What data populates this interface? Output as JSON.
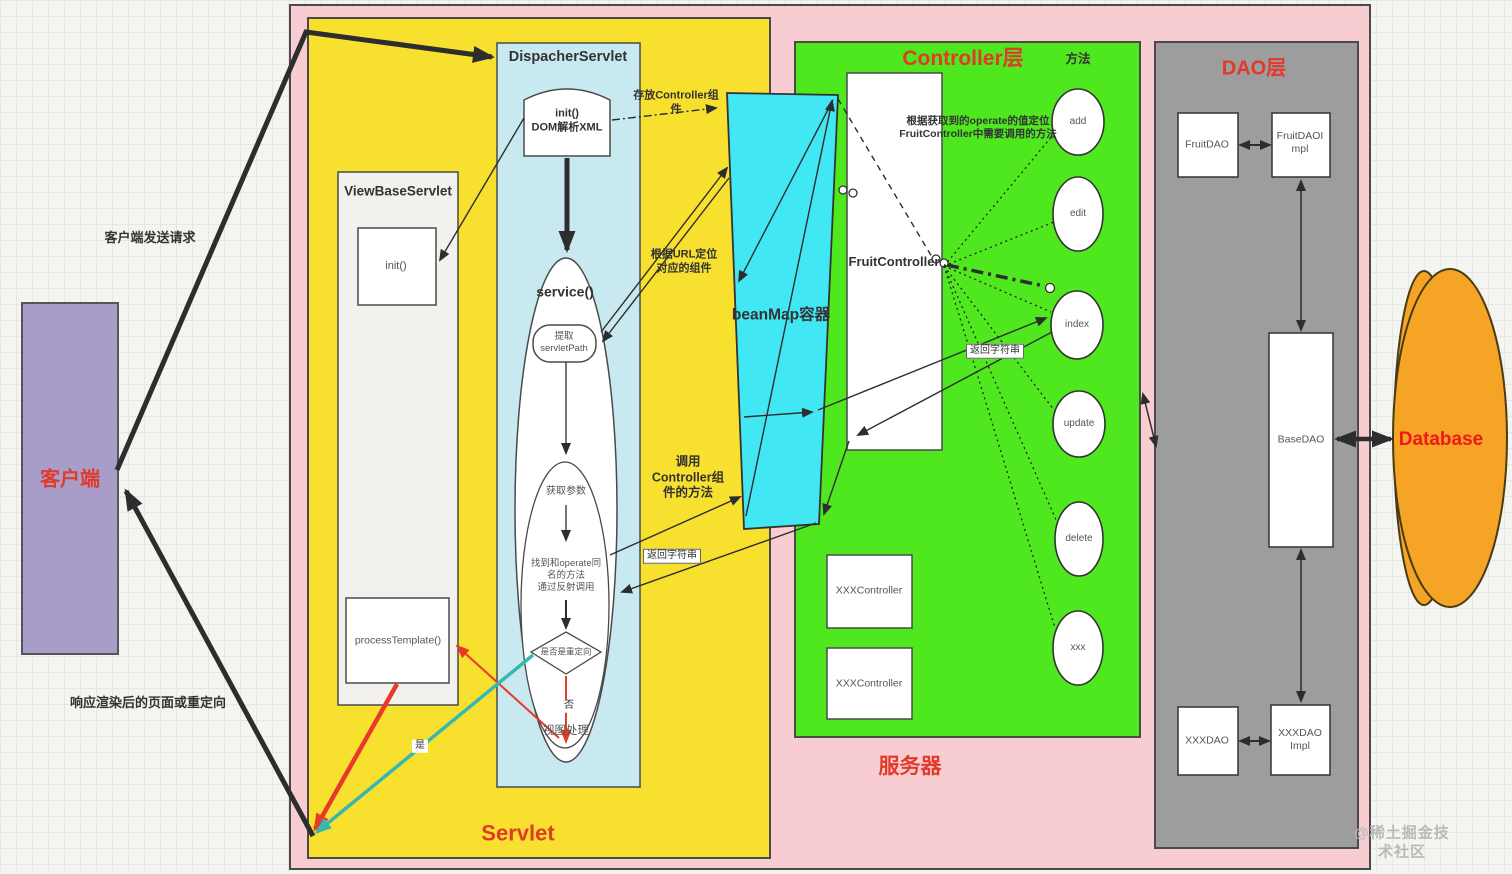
{
  "client": {
    "label": "客户端"
  },
  "flows": {
    "request": "客户端发送请求",
    "response": "响应渲染后的页面或重定向"
  },
  "servlet_panel": {
    "title": "Servlet",
    "view_base_servlet": {
      "title": "ViewBaseServlet",
      "init": "init()",
      "process_template": "processTemplate()"
    },
    "dispatcher": {
      "title": "DispacherServlet",
      "init_dom": "init()\nDOM解析XML",
      "service": "service()",
      "extract_servlet_path": "提取\nservletPath",
      "get_params": "获取参数",
      "find_method": "找到和operate同\n名的方法\n通过反射调用",
      "is_redirect": "是否是重定向",
      "no": "否",
      "view_process": "视图处理",
      "yes": "是"
    }
  },
  "bean_map": {
    "label": "beanMap容器",
    "store_note": "存放Controller组\n件",
    "locate_note": "根据URL定位\n对应的组件",
    "invoke_note": "调用\nController组\n件的方法",
    "return_note": "返回字符串"
  },
  "controller_panel": {
    "title": "Controller层",
    "methods_title": "方法",
    "operate_note": "根据获取到的operate的值定位\nFruitController中需要调用的方法",
    "fruit_controller": "FruitController",
    "return_note": "返回字符串",
    "xxx_controllers": [
      "XXXController",
      "XXXController"
    ],
    "methods": [
      "add",
      "edit",
      "index",
      "update",
      "delete",
      "xxx"
    ],
    "server_label": "服务器"
  },
  "dao_panel": {
    "title": "DAO层",
    "fruit_dao": "FruitDAO",
    "fruit_dao_impl": "FruitDAOI\nmpl",
    "base_dao": "BaseDAO",
    "xxx_dao": "XXXDAO",
    "xxx_dao_impl": "XXXDAO\nImpl"
  },
  "database": {
    "label": "Database"
  },
  "watermark": "@稀土掘金技术社区",
  "colors": {
    "panel_pink": "#f8cdd2",
    "panel_yellow": "#f7e02e",
    "panel_blue": "#c9e9f0",
    "panel_cyan": "#41e7f2",
    "panel_green": "#4fe81f",
    "panel_gray": "#9d9d9d",
    "client_purple": "#a89cc8",
    "database_orange": "#f5a425",
    "accent_red": "#e23a2a",
    "arrow_red": "#e8392b",
    "arrow_teal": "#35b8b0",
    "arrow_black": "#2d2d2d"
  }
}
